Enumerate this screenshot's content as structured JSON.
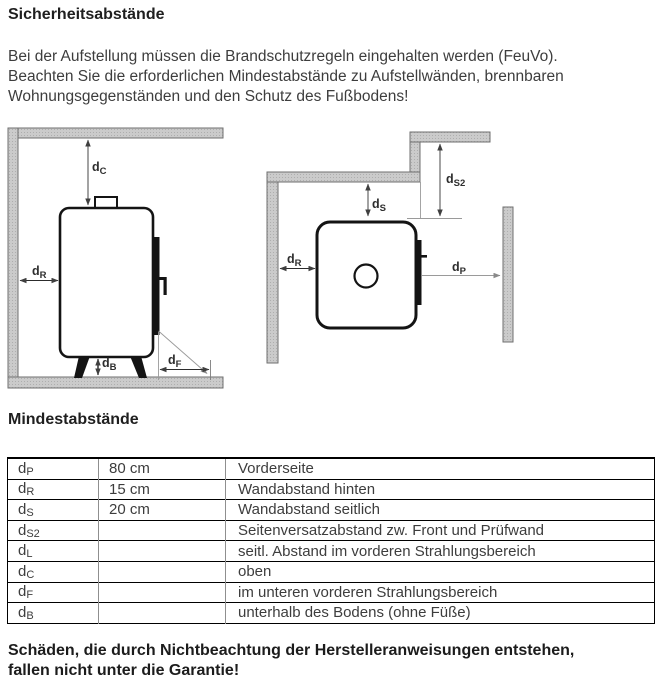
{
  "page": {
    "title": "Sicherheitsabstände",
    "intro_lines": [
      "Bei der Aufstellung müssen die Brandschutzregeln eingehalten werden (FeuVo).",
      "Beachten Sie die erforderlichen Mindestabstände zu Aufstellwänden, brennbaren",
      "Wohnungsgegenständen und den Schutz des Fußbodens!"
    ],
    "warning_lines": [
      "Schäden, die durch Nichtbeachtung der Herstelleranweisungen entstehen,",
      "fallen nicht unter die Garantie!"
    ]
  },
  "diagram_labels": {
    "dc": {
      "base": "d",
      "sub": "C"
    },
    "dr_side": {
      "base": "d",
      "sub": "R"
    },
    "db": {
      "base": "d",
      "sub": "B"
    },
    "df": {
      "base": "d",
      "sub": "F"
    },
    "ds": {
      "base": "d",
      "sub": "S"
    },
    "ds2": {
      "base": "d",
      "sub": "S2"
    },
    "dr_top": {
      "base": "d",
      "sub": "R"
    },
    "dp": {
      "base": "d",
      "sub": "P"
    }
  },
  "table": {
    "heading": "Mindestabstände",
    "rows": [
      {
        "symbol_base": "d",
        "symbol_sub": "P",
        "value": "80 cm",
        "description": "Vorderseite"
      },
      {
        "symbol_base": "d",
        "symbol_sub": "R",
        "value": "15 cm",
        "description": "Wandabstand hinten"
      },
      {
        "symbol_base": "d",
        "symbol_sub": "S",
        "value": "20 cm",
        "description": "Wandabstand seitlich"
      },
      {
        "symbol_base": "d",
        "symbol_sub": "S2",
        "value": "",
        "description": "Seitenversatzabstand zw. Front und Prüfwand"
      },
      {
        "symbol_base": "d",
        "symbol_sub": "L",
        "value": "",
        "description": "seitl. Abstand im vorderen Strahlungsbereich"
      },
      {
        "symbol_base": "d",
        "symbol_sub": "C",
        "value": "",
        "description": "oben"
      },
      {
        "symbol_base": "d",
        "symbol_sub": "F",
        "value": "",
        "description": "im unteren vorderen Strahlungsbereich"
      },
      {
        "symbol_base": "d",
        "symbol_sub": "B",
        "value": "",
        "description": "unterhalb des Bodens (ohne Füße)"
      }
    ]
  },
  "colors": {
    "wall_fill": "#cbcbcb",
    "wall_border": "#6f6f6f",
    "stove_line": "#141414",
    "measure_line": "#474747",
    "extension_line": "#9a9a9a",
    "text": "#3d3d3d"
  }
}
